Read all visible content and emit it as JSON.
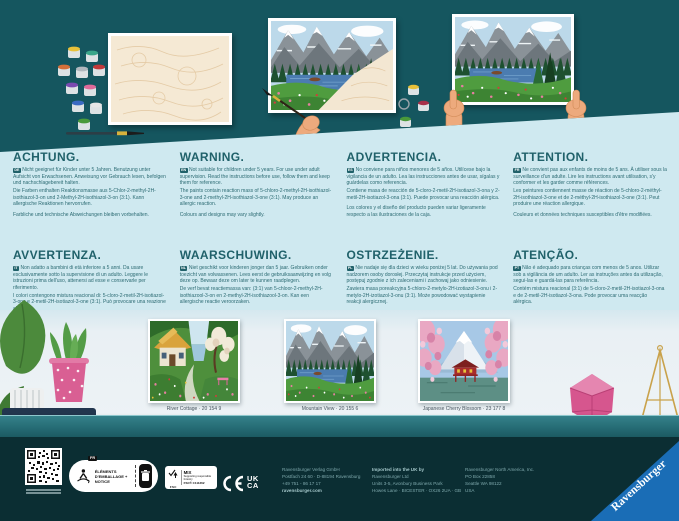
{
  "colors": {
    "hero_teal": "#15565f",
    "panel_blue": "#cfe9f0",
    "text_teal": "#2c6b73",
    "shelf_teal": "#2a7077",
    "footer_dark": "#0b2e33",
    "brand_blue": "#1a6db6"
  },
  "hero": {
    "panels": [
      "blank-numbered-canvas-with-paint-pots",
      "half-painted-canvas-with-hand",
      "finished-painting-held-by-hands"
    ]
  },
  "warnings": [
    {
      "lang": "DE",
      "title": "ACHTUNG.",
      "p1": "Nicht geeignet für Kinder unter 5 Jahren. Benutzung unter Aufsicht von Erwachsenen. Anweisung vor Gebrauch lesen, befolgen und nachschlagebereit halten.",
      "p2": "Die Farben enthalten Reaktionsmasse aus 5-Chlor-2-methyl-2H-isothiazol-3-on und 2-Methyl-2H-isothiazol-3-on (3:1). Kann allergische Reaktionen hervorrufen.",
      "p3": "Farbliche und technische Abweichungen bleiben vorbehalten."
    },
    {
      "lang": "EN",
      "title": "WARNING.",
      "p1": "Not suitable for children under 5 years. For use under adult supervision. Read the instructions before use, follow them and keep them for reference.",
      "p2": "The paints contain reaction mass of 5-chloro-2-methyl-2H-isothiazol-3-one and 2-methyl-2H-isothiazol-3-one (3:1). May produce an allergic reaction.",
      "p3": "Colours and designs may vary slightly."
    },
    {
      "lang": "ES",
      "title": "ADVERTENCIA.",
      "p1": "No conviene para niños menores de 5 años. Utilícese bajo la vigilancia de un adulto. Lea las instrucciones antes de usar, sígalas y guárdelas como referencia.",
      "p2": "Contiene masa de reacción de 5-cloro-2-metil-2H-isotiazol-3-ona y 2-metil-2H-isotiazol-3-ona (3:1). Puede provocar una reacción alérgica.",
      "p3": "Los colores y el diseño del producto pueden variar ligeramente respecto a las ilustraciones de la caja."
    },
    {
      "lang": "FR",
      "title": "ATTENTION.",
      "p1": "Ne convient pas aux enfants de moins de 5 ans. À utiliser sous la surveillance d'un adulte. Lire les instructions avant utilisation, s'y conformer et les garder comme références.",
      "p2": "Les peintures contiennent masse de réaction de 5-chloro-2-méthyl-2H-isothiazol-3-one et de 2-méthyl-2H-isothiazol-3-one (3:1). Peut produire une réaction allergique.",
      "p3": "Couleurs et données techniques susceptibles d'être modifiées."
    },
    {
      "lang": "IT",
      "title": "AVVERTENZA.",
      "p1": "Non adatto a bambini di età inferiore a 5 anni. Da usare esclusivamente sotto la supervisione di un adulto. Leggere le istruzioni prima dell'uso, attenersi ad esse e conservarle per riferimento.",
      "p2": "I colori contengono mistura reacional di: 5-cloro-2-metil-2H-isotiazol-3-one e 2-metil-2H-isotiazol-3-one (3:1). Può provocare una reazione allergica.",
      "p3": "I colori e le forme del prodotto potrebbero leggermente variare da quanto illustrato sulla confezione."
    },
    {
      "lang": "NL",
      "title": "WAARSCHUWING.",
      "p1": "Niet geschikt voor kinderen jonger dan 5 jaar. Gebruiken onder toezicht van volwassenen. Lees eerst de gebruiksaanwijzing en volg deze op. Bewaar deze om later te kunnen raadplegen.",
      "p2": "De verf bevat reactiemassa van: (3:1) van 5-chloor-2-methyl-2H-isothiazool-3-on en 2-methyl-2H-isothiazool-3-on. Kan een allergische reactie veroorzaken.",
      "p3": "Afwijkingen in kleur en techniek voorbehouden."
    },
    {
      "lang": "PL",
      "title": "OSTRZEŻENIE.",
      "p1": "Nie nadaje się dla dzieci w wieku poniżej 5 lat. Do używania pod nadzorem osoby dorosłej. Przeczytaj instrukcje przed użyciem, postępuj zgodnie z ich zaleceniami i zachowaj jako odniesienie.",
      "p2": "Zawiera masa poreakcyjna 5-chloro-2-metylo-2H-izotiazol-3-onu i 2-metylo-2H-izotiazol-3-onu (3:1). Może powodować wystąpienie reakcji alergicznej.",
      "p3": "Zastrzega się możliwość odchyleń kolorystycznych i technicznych."
    },
    {
      "lang": "PT",
      "title": "ATENÇÃO.",
      "p1": "Não é adequado para crianças com menos de 5 anos. Utilizar sob a vigilância de um adulto. Ler as instruções antes da utilização, segui-las e guardá-las para referência.",
      "p2": "Contém mistura reacional (3:1) de 5-cloro-2-metil-2H-isotiazol-3-ona e de 2-metil-2H-isotiazol-3-ona. Pode provocar uma reacção alérgica.",
      "p3": "Reservamo-nos o direito de introduzir alterações técnicas e mudanças de cor."
    }
  ],
  "products": [
    {
      "caption": "River Cottage · 20 154 9"
    },
    {
      "caption": "Mountain View · 20 155 6"
    },
    {
      "caption": "Japanese Cherry Blossom · 23 177 8"
    }
  ],
  "footer": {
    "triman_tag": "FR",
    "triman_label": "ÉLÉMENTS D'EMBALLAGE + NOTICE",
    "fsc_title": "FSC",
    "fsc_mix": "MIX",
    "fsc_sub": "Supporting responsible forestry",
    "fsc_code": "FSC® C111262",
    "ukca_top": "UK",
    "ukca_bottom": "CA",
    "addresses": [
      {
        "l1": "Ravensburger Verlag GmbH",
        "l2": "Postfach 24 60 · D-88194 Ravensburg",
        "l3": "+49 751 - 86 17 17",
        "l4": "ravensburger.com"
      },
      {
        "l1": "Imported into the UK by",
        "l2": "Ravensburger Ltd",
        "l3": "Units 3-5, Avonbury Business Park",
        "l4": "Howes Lane · BICESTER · OX26 2UA · GB"
      },
      {
        "l1": "Ravensburger North America, Inc.",
        "l2": "PO Box 22858",
        "l3": "Seattle WA 98122",
        "l4": "USA"
      }
    ],
    "brand": "Ravensburger"
  }
}
